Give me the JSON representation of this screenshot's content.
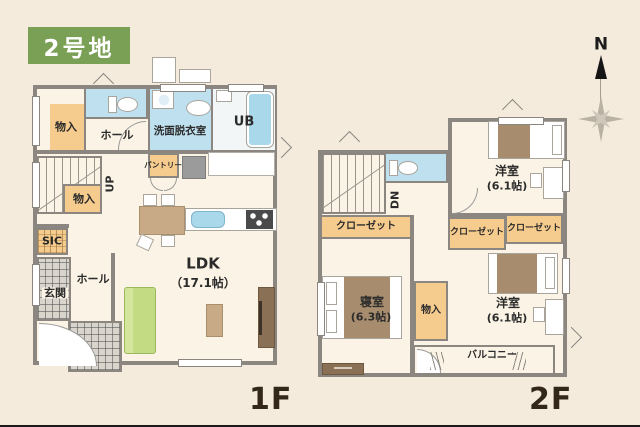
{
  "badge": {
    "text": "2号地",
    "bg": "#7aa055"
  },
  "compass": {
    "north": "N"
  },
  "colors": {
    "background": "#f4ebdd",
    "floor": "#fbf4e6",
    "wall_gray": "#8b8780",
    "wet_room_blue": "#bfe0ef",
    "closet_orange": "#f6cb8e",
    "sofa_green": "#c3dc83",
    "wood_tan": "#c8ab86",
    "dark_wood": "#8a7055"
  },
  "f1": {
    "floor_label": "1F",
    "rooms": {
      "storage_top": "物入",
      "toilet_hall": "ホール",
      "washroom": "洗面脱衣室",
      "bath": "UB",
      "pantry": "パントリー",
      "stairs_up": "UP",
      "storage_stairs": "物入",
      "sic": "SIC",
      "entrance": "玄関",
      "entrance_hall": "ホール",
      "ldk_name": "LDK",
      "ldk_size": "（17.1帖）"
    }
  },
  "f2": {
    "floor_label": "2F",
    "rooms": {
      "stairs_down": "DN",
      "closet_bedroom": "クローゼット",
      "closet_east_a": "クローゼット",
      "closet_east_b": "クローゼット",
      "western_north_name": "洋室",
      "western_north_size": "(6.1帖)",
      "bedroom_name": "寝室",
      "bedroom_size": "(6.3帖)",
      "storage": "物入",
      "western_south_name": "洋室",
      "western_south_size": "(6.1帖)",
      "balcony": "バルコニー"
    }
  }
}
